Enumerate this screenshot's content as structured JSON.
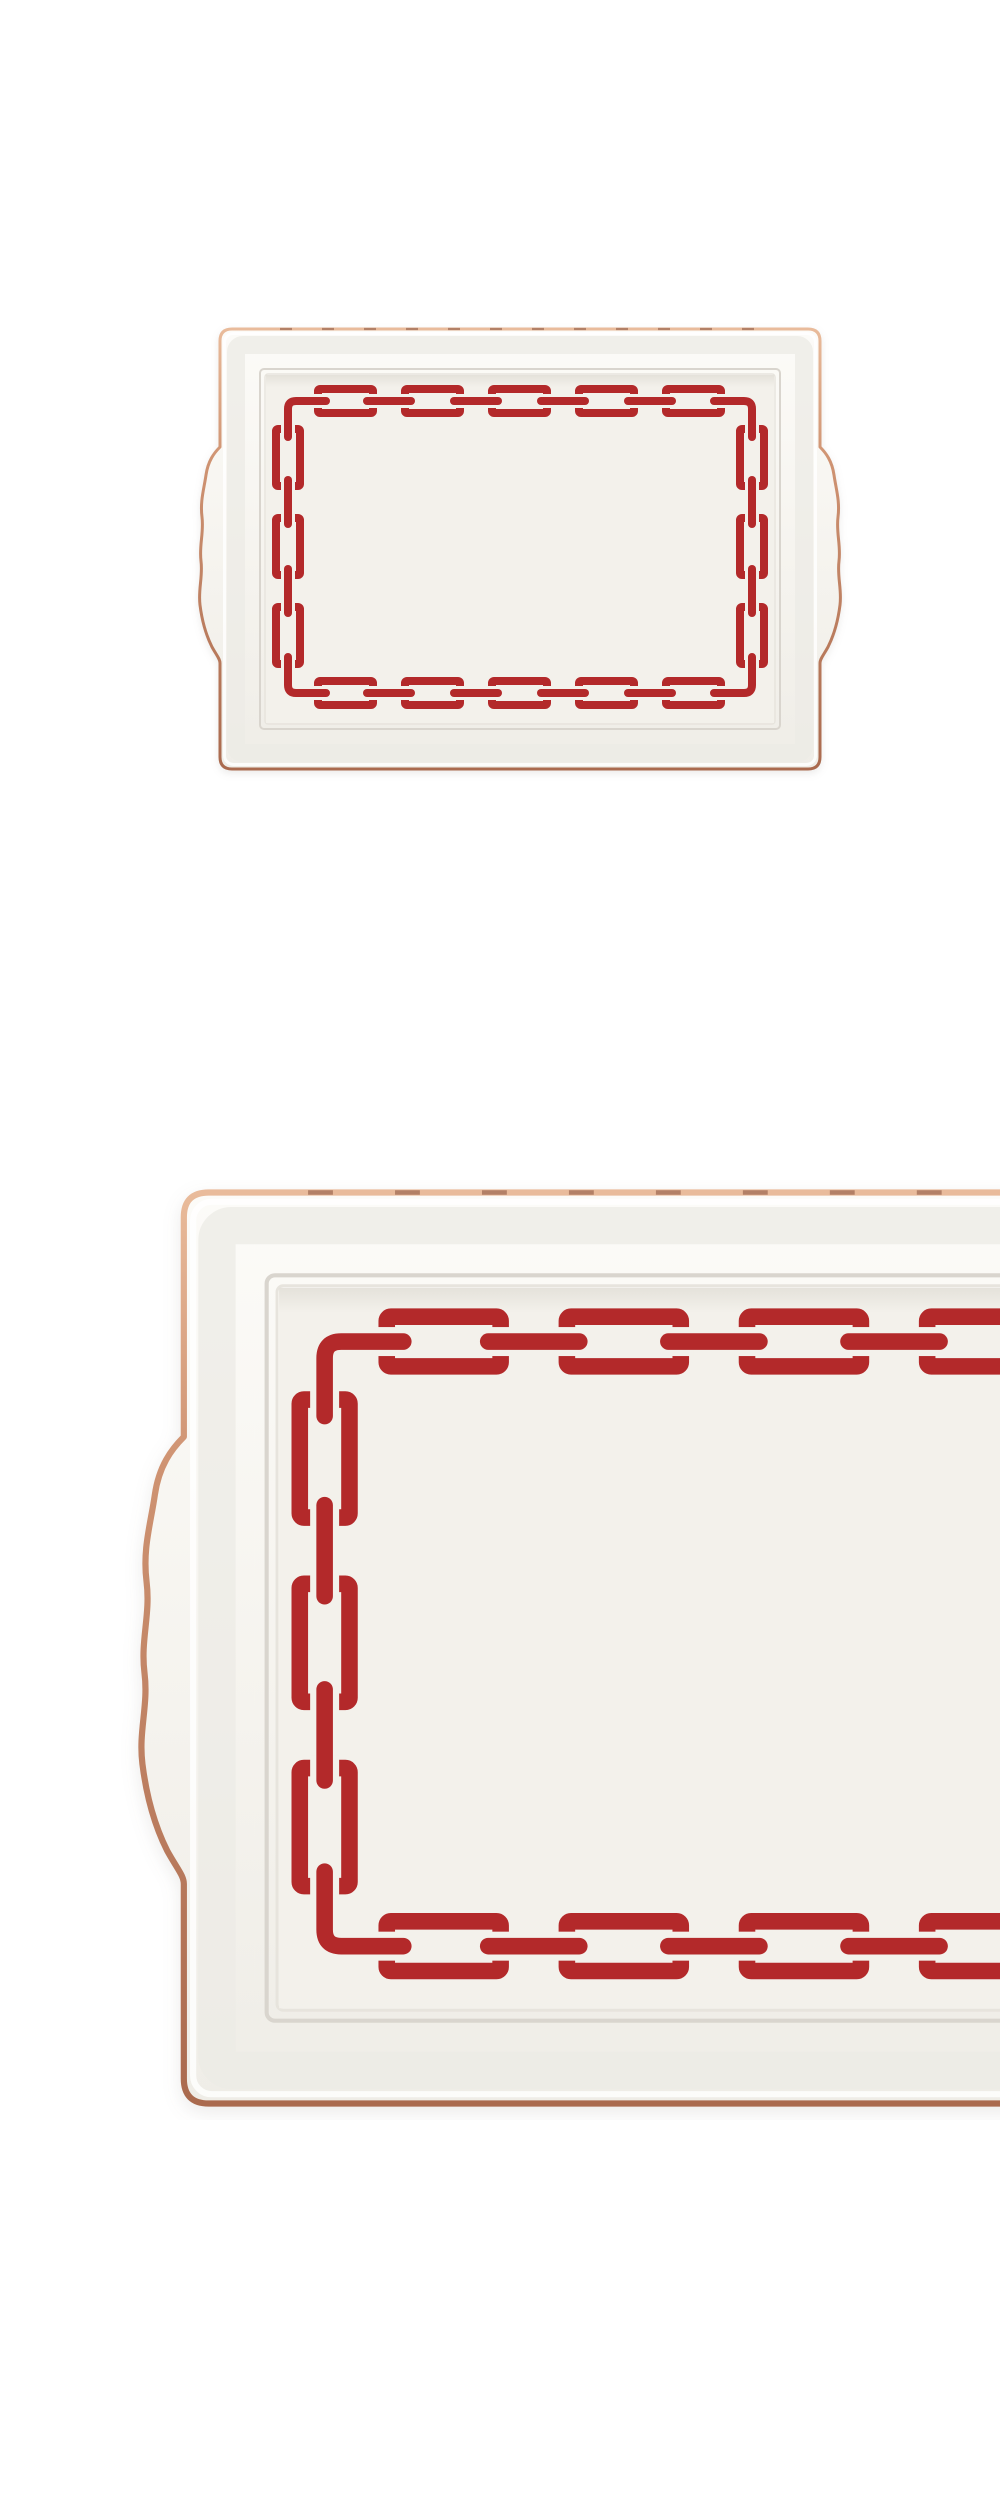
{
  "page": {
    "background_color": "#ffffff",
    "width_px": 1000,
    "height_px": 2501
  },
  "palette": {
    "porcelain_light": "#fcfbf8",
    "porcelain_mid": "#f6f4ef",
    "porcelain_floor": "#f3f1eb",
    "chain_red": "#b3292a",
    "copper_light": "#e9bb9b",
    "copper_mid": "#cf9372",
    "copper_dark": "#aa6a4e",
    "bevel_line": "#d9d5ce",
    "page_bg": "#ffffff"
  },
  "figures": [
    {
      "name": "tray-full-view",
      "alt": "White porcelain rectangular serving tray with red chain-link border pattern, copper rim and wavy side handles, full view on white background"
    },
    {
      "name": "tray-detail-view",
      "alt": "Enlarged detail of the same tray showing the left side: copper rim, left handle and red chain-link pattern, cropped at the right edge"
    }
  ],
  "chain_pattern": {
    "top_links": 5,
    "bottom_links": 5,
    "left_links": 3,
    "right_links": 3,
    "corner_links": 4,
    "connector_style": "rounded bar passing through open link sides"
  }
}
